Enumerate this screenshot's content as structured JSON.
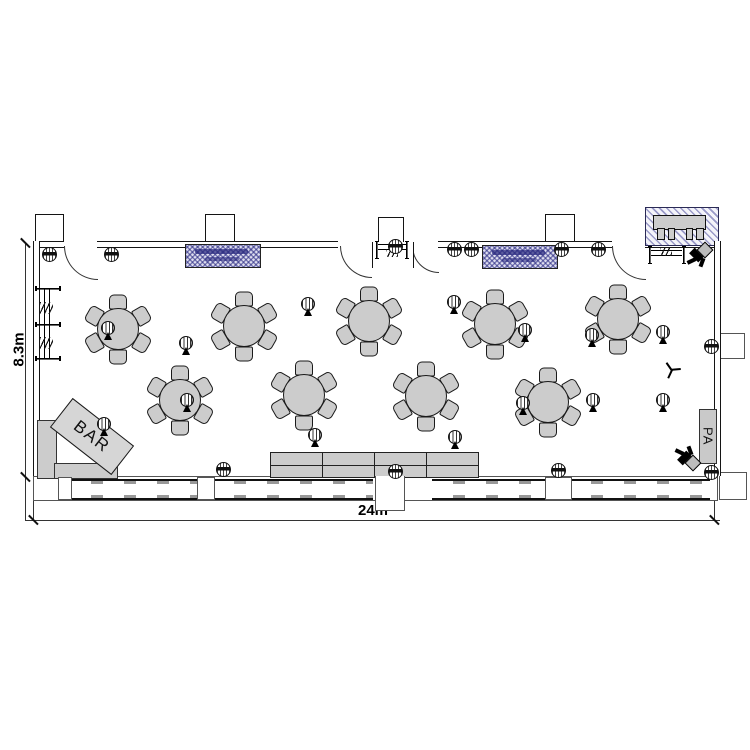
{
  "plan": {
    "labels": {
      "bar": "BAR",
      "pa": "PA",
      "width_dim": "24m",
      "height_dim": "8.3m"
    },
    "colors": {
      "wall": "#141414",
      "furniture_fill": "#cccccc",
      "hatch_blue": "#23237a",
      "hatch_blue_bg": "#dedeef",
      "hatch_stripe": "#9a9ac8"
    },
    "tables": [
      {
        "x": 117,
        "y": 328
      },
      {
        "x": 243,
        "y": 325
      },
      {
        "x": 368,
        "y": 320
      },
      {
        "x": 494,
        "y": 323
      },
      {
        "x": 617,
        "y": 318
      },
      {
        "x": 179,
        "y": 399
      },
      {
        "x": 303,
        "y": 394
      },
      {
        "x": 425,
        "y": 395
      },
      {
        "x": 547,
        "y": 401
      }
    ],
    "chairs_per_table": 6,
    "plants": [
      {
        "x": 108,
        "y": 329
      },
      {
        "x": 186,
        "y": 344
      },
      {
        "x": 308,
        "y": 305
      },
      {
        "x": 454,
        "y": 303
      },
      {
        "x": 525,
        "y": 331
      },
      {
        "x": 592,
        "y": 336
      },
      {
        "x": 663,
        "y": 333
      },
      {
        "x": 104,
        "y": 425
      },
      {
        "x": 187,
        "y": 401
      },
      {
        "x": 315,
        "y": 436
      },
      {
        "x": 455,
        "y": 438
      },
      {
        "x": 523,
        "y": 404
      },
      {
        "x": 593,
        "y": 401
      },
      {
        "x": 663,
        "y": 401
      }
    ],
    "stools": [
      {
        "x": 48,
        "y": 253
      },
      {
        "x": 110,
        "y": 253
      },
      {
        "x": 394,
        "y": 245
      },
      {
        "x": 453,
        "y": 248
      },
      {
        "x": 470,
        "y": 248
      },
      {
        "x": 560,
        "y": 248
      },
      {
        "x": 597,
        "y": 248
      },
      {
        "x": 710,
        "y": 345
      },
      {
        "x": 222,
        "y": 468
      },
      {
        "x": 394,
        "y": 470
      },
      {
        "x": 557,
        "y": 469
      },
      {
        "x": 710,
        "y": 471
      }
    ],
    "speakers": [
      {
        "x": 687,
        "y": 243,
        "flip": false
      },
      {
        "x": 675,
        "y": 446,
        "flip": true
      }
    ]
  }
}
